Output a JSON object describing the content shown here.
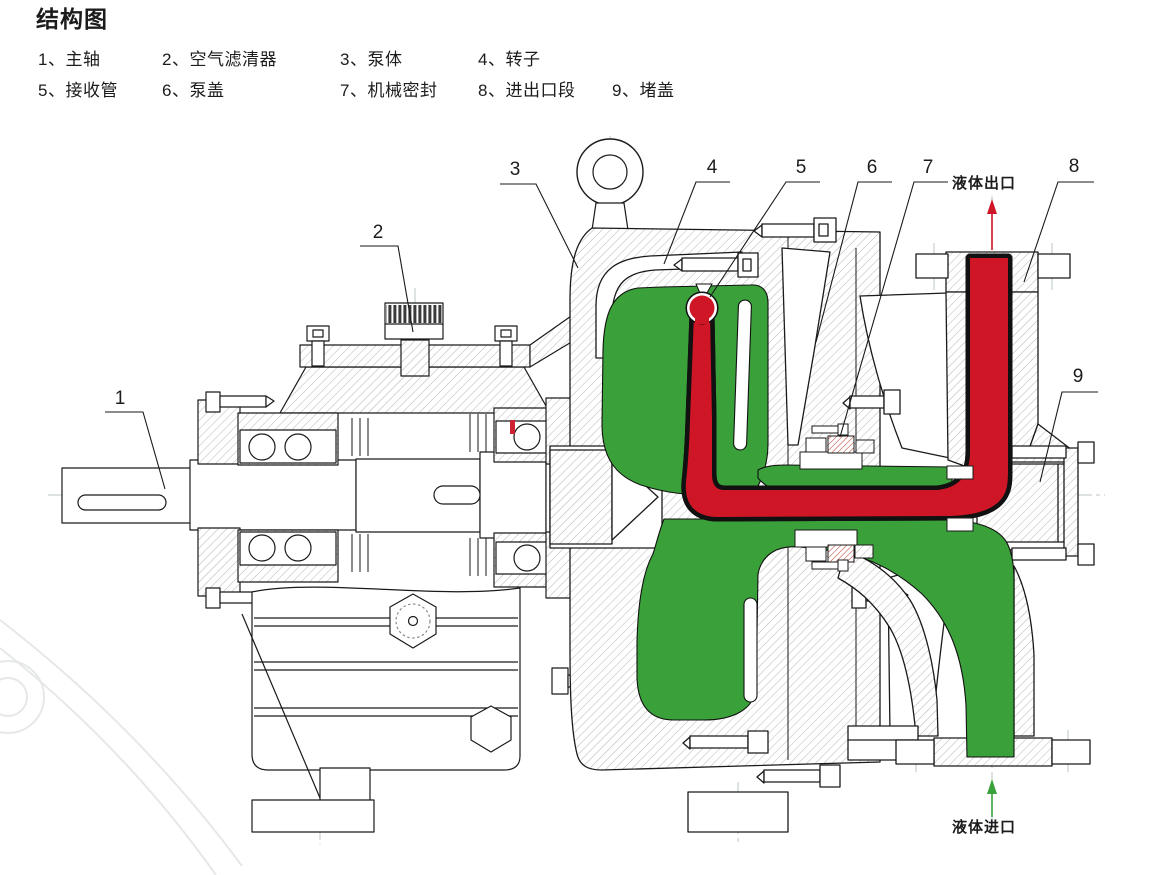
{
  "title": "结构图",
  "legend": {
    "items": [
      "1、主轴",
      "2、空气滤清器",
      "3、泵体",
      "4、转子",
      "5、接收管",
      "6、泵盖",
      "7、机械密封",
      "8、进出口段",
      "9、堵盖"
    ]
  },
  "callouts": [
    "1",
    "2",
    "3",
    "4",
    "5",
    "6",
    "7",
    "8",
    "9"
  ],
  "ports": {
    "outlet": "液体出口",
    "inlet": "液体进口"
  },
  "colors": {
    "flow_green": "#3aa03a",
    "flow_red": "#cf1626"
  }
}
